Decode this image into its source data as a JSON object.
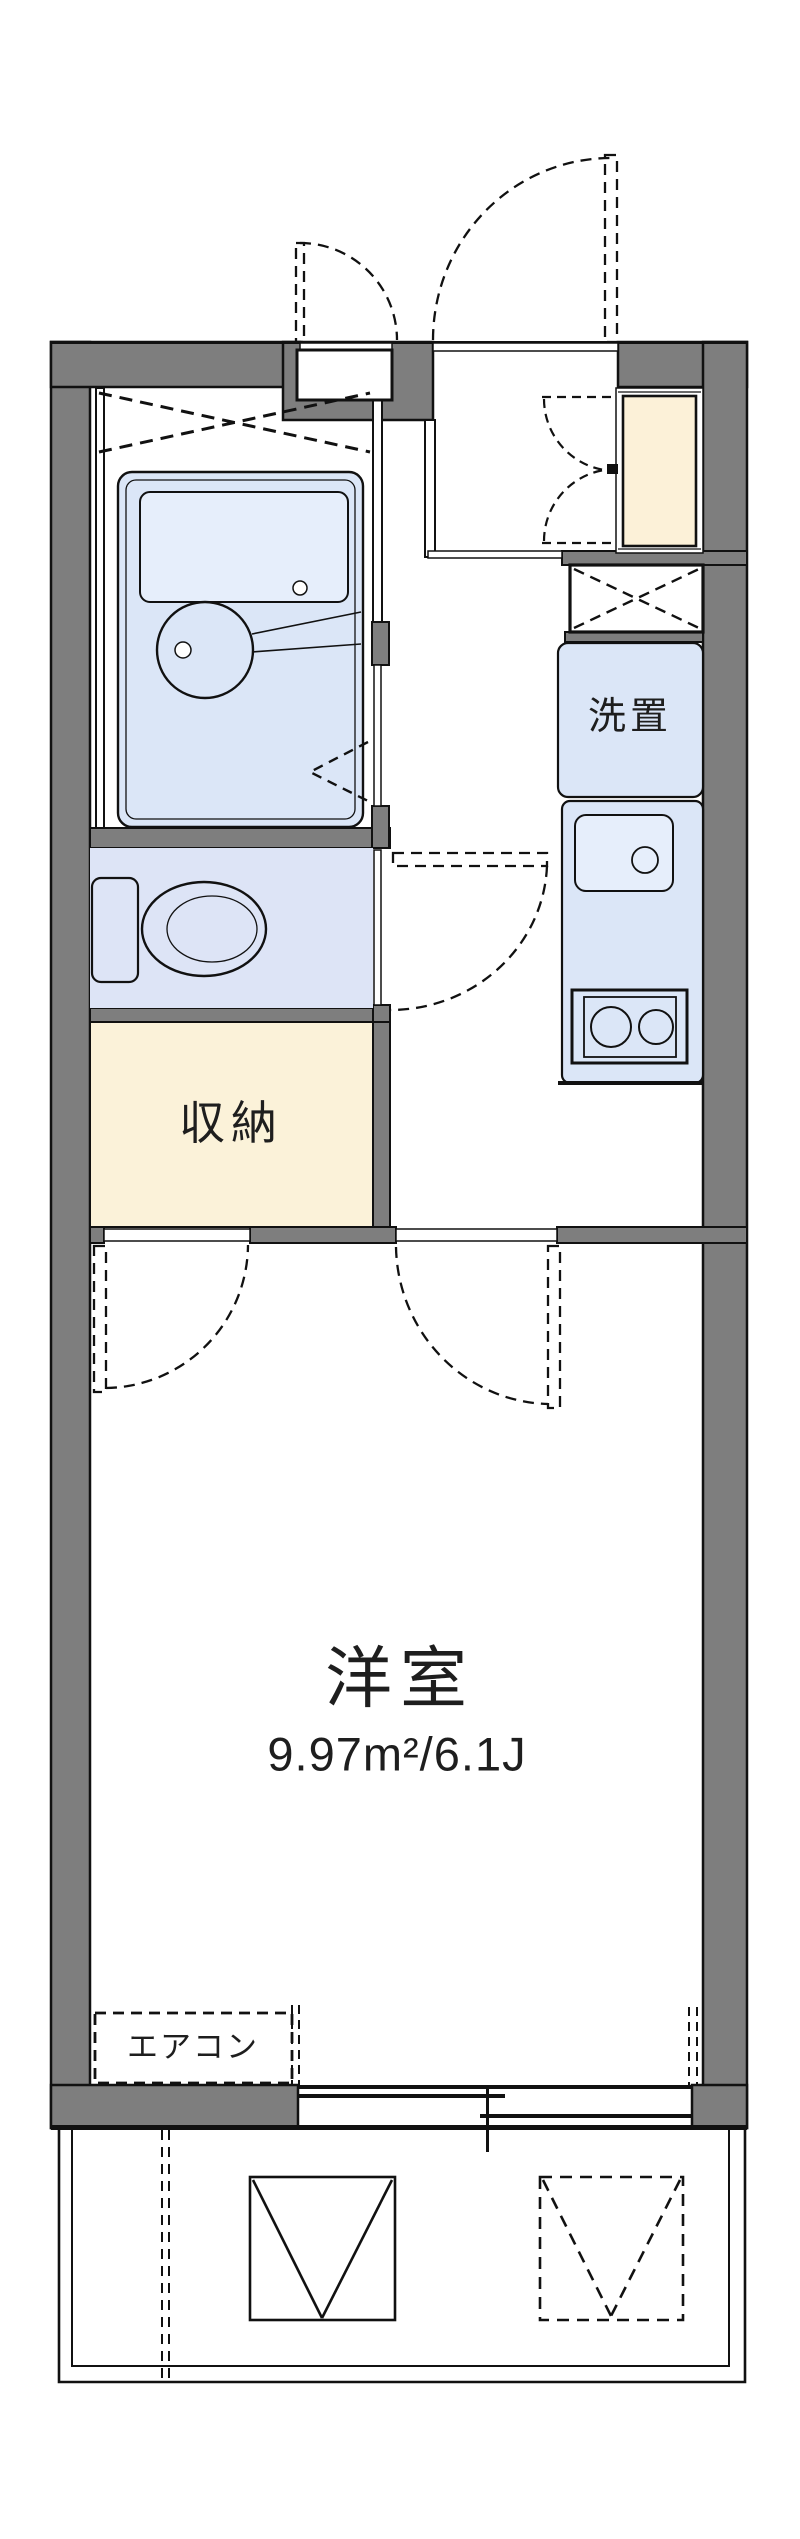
{
  "plan": {
    "rooms": {
      "western_room": {
        "label": "洋室",
        "size": "9.97m²/6.1J"
      },
      "storage": {
        "label": "収納"
      },
      "laundry": {
        "label": "洗置"
      },
      "aircon": {
        "label": "エアコン"
      }
    },
    "colors": {
      "wall": "#7e7e7e",
      "fixture_blue": "#dbe6f7",
      "toilet_blue": "#dde4f6",
      "shoe_cream": "#fcf1d8",
      "storage_cream": "#fbf2d9",
      "line": "#111111"
    }
  }
}
